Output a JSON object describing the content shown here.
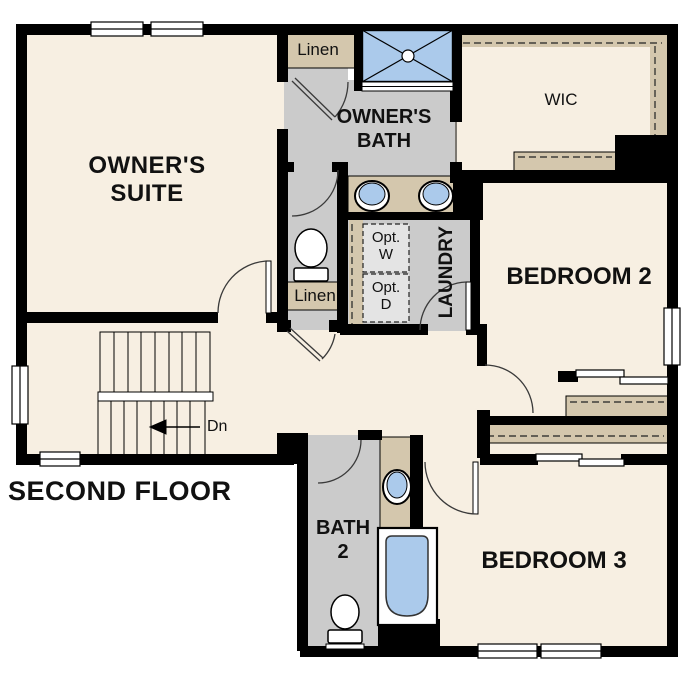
{
  "floor_label": "SECOND FLOOR",
  "rooms": {
    "owners_suite": "OWNER'S\nSUITE",
    "owners_bath": "OWNER'S\nBATH",
    "wic": "WIC",
    "bedroom_2": "BEDROOM 2",
    "bedroom_3": "BEDROOM 3",
    "bath_2": "BATH\n2",
    "laundry": "LAUNDRY",
    "linen_upper": "Linen",
    "linen_lower": "Linen",
    "opt_washer": "Opt.\nW",
    "opt_dryer": "Opt.\nD"
  },
  "stairs": {
    "direction_label": "Dn"
  },
  "colors": {
    "floor_cream": "#f7efe2",
    "room_gray": "#cbcbcb",
    "shelf_tan": "#d4c7ad",
    "fixture_blue": "#abcaeb",
    "appliance_gray": "#e4e4e4",
    "wall_black": "#000000"
  },
  "fixtures": [
    "shower-stall",
    "double-vanity-sink",
    "toilet",
    "linen-shelf",
    "optional-washer",
    "optional-dryer",
    "stairs-down",
    "bathtub",
    "single-vanity-sink",
    "closet-sliding-doors",
    "windows"
  ]
}
